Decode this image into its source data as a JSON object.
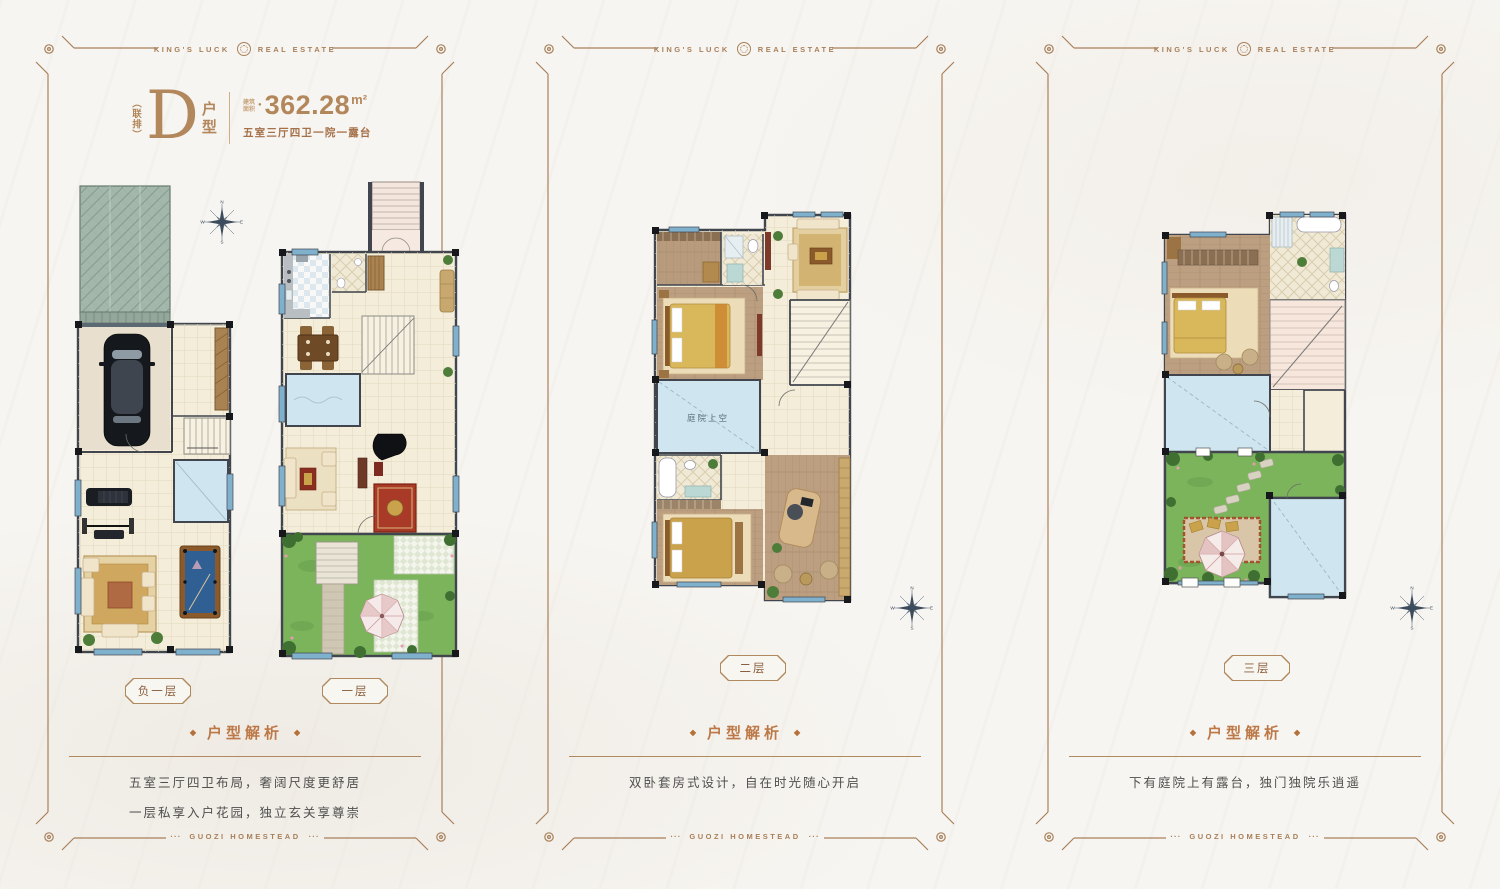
{
  "brand": {
    "name_left": "KING'S LUCK",
    "name_right": "REAL ESTATE",
    "footer": "GUOZI HOMESTEAD",
    "accent_color": "#a8805a"
  },
  "unit": {
    "tag": "（联排）",
    "letter": "D",
    "suffix_char_1": "户",
    "suffix_char_2": "型",
    "area_label_line_1": "建筑",
    "area_label_line_2": "面积",
    "area_value": "362.28",
    "area_unit": "m²",
    "spec": "五室三厅四卫一院一露台"
  },
  "icons": {
    "diamond": "◆",
    "dot": "●",
    "footer_ticks": "···"
  },
  "compass": {
    "n": "N",
    "e": "E",
    "s": "S",
    "w": "W"
  },
  "panels": [
    {
      "analysis_title": "户型解析",
      "analysis_lines": [
        "五室三厅四卫布局，奢阔尺度更舒居",
        "一层私享入户花园，独立玄关享尊崇"
      ],
      "floor_badges": [
        "负一层",
        "一层"
      ]
    },
    {
      "analysis_title": "户型解析",
      "analysis_lines": [
        "双卧套房式设计，自在时光随心开启"
      ],
      "floor_badges": [
        "二层"
      ],
      "plan_label": "庭院上空"
    },
    {
      "analysis_title": "户型解析",
      "analysis_lines": [
        "下有庭院上有露台，独门独院乐逍遥"
      ],
      "floor_badges": [
        "三层"
      ]
    }
  ]
}
